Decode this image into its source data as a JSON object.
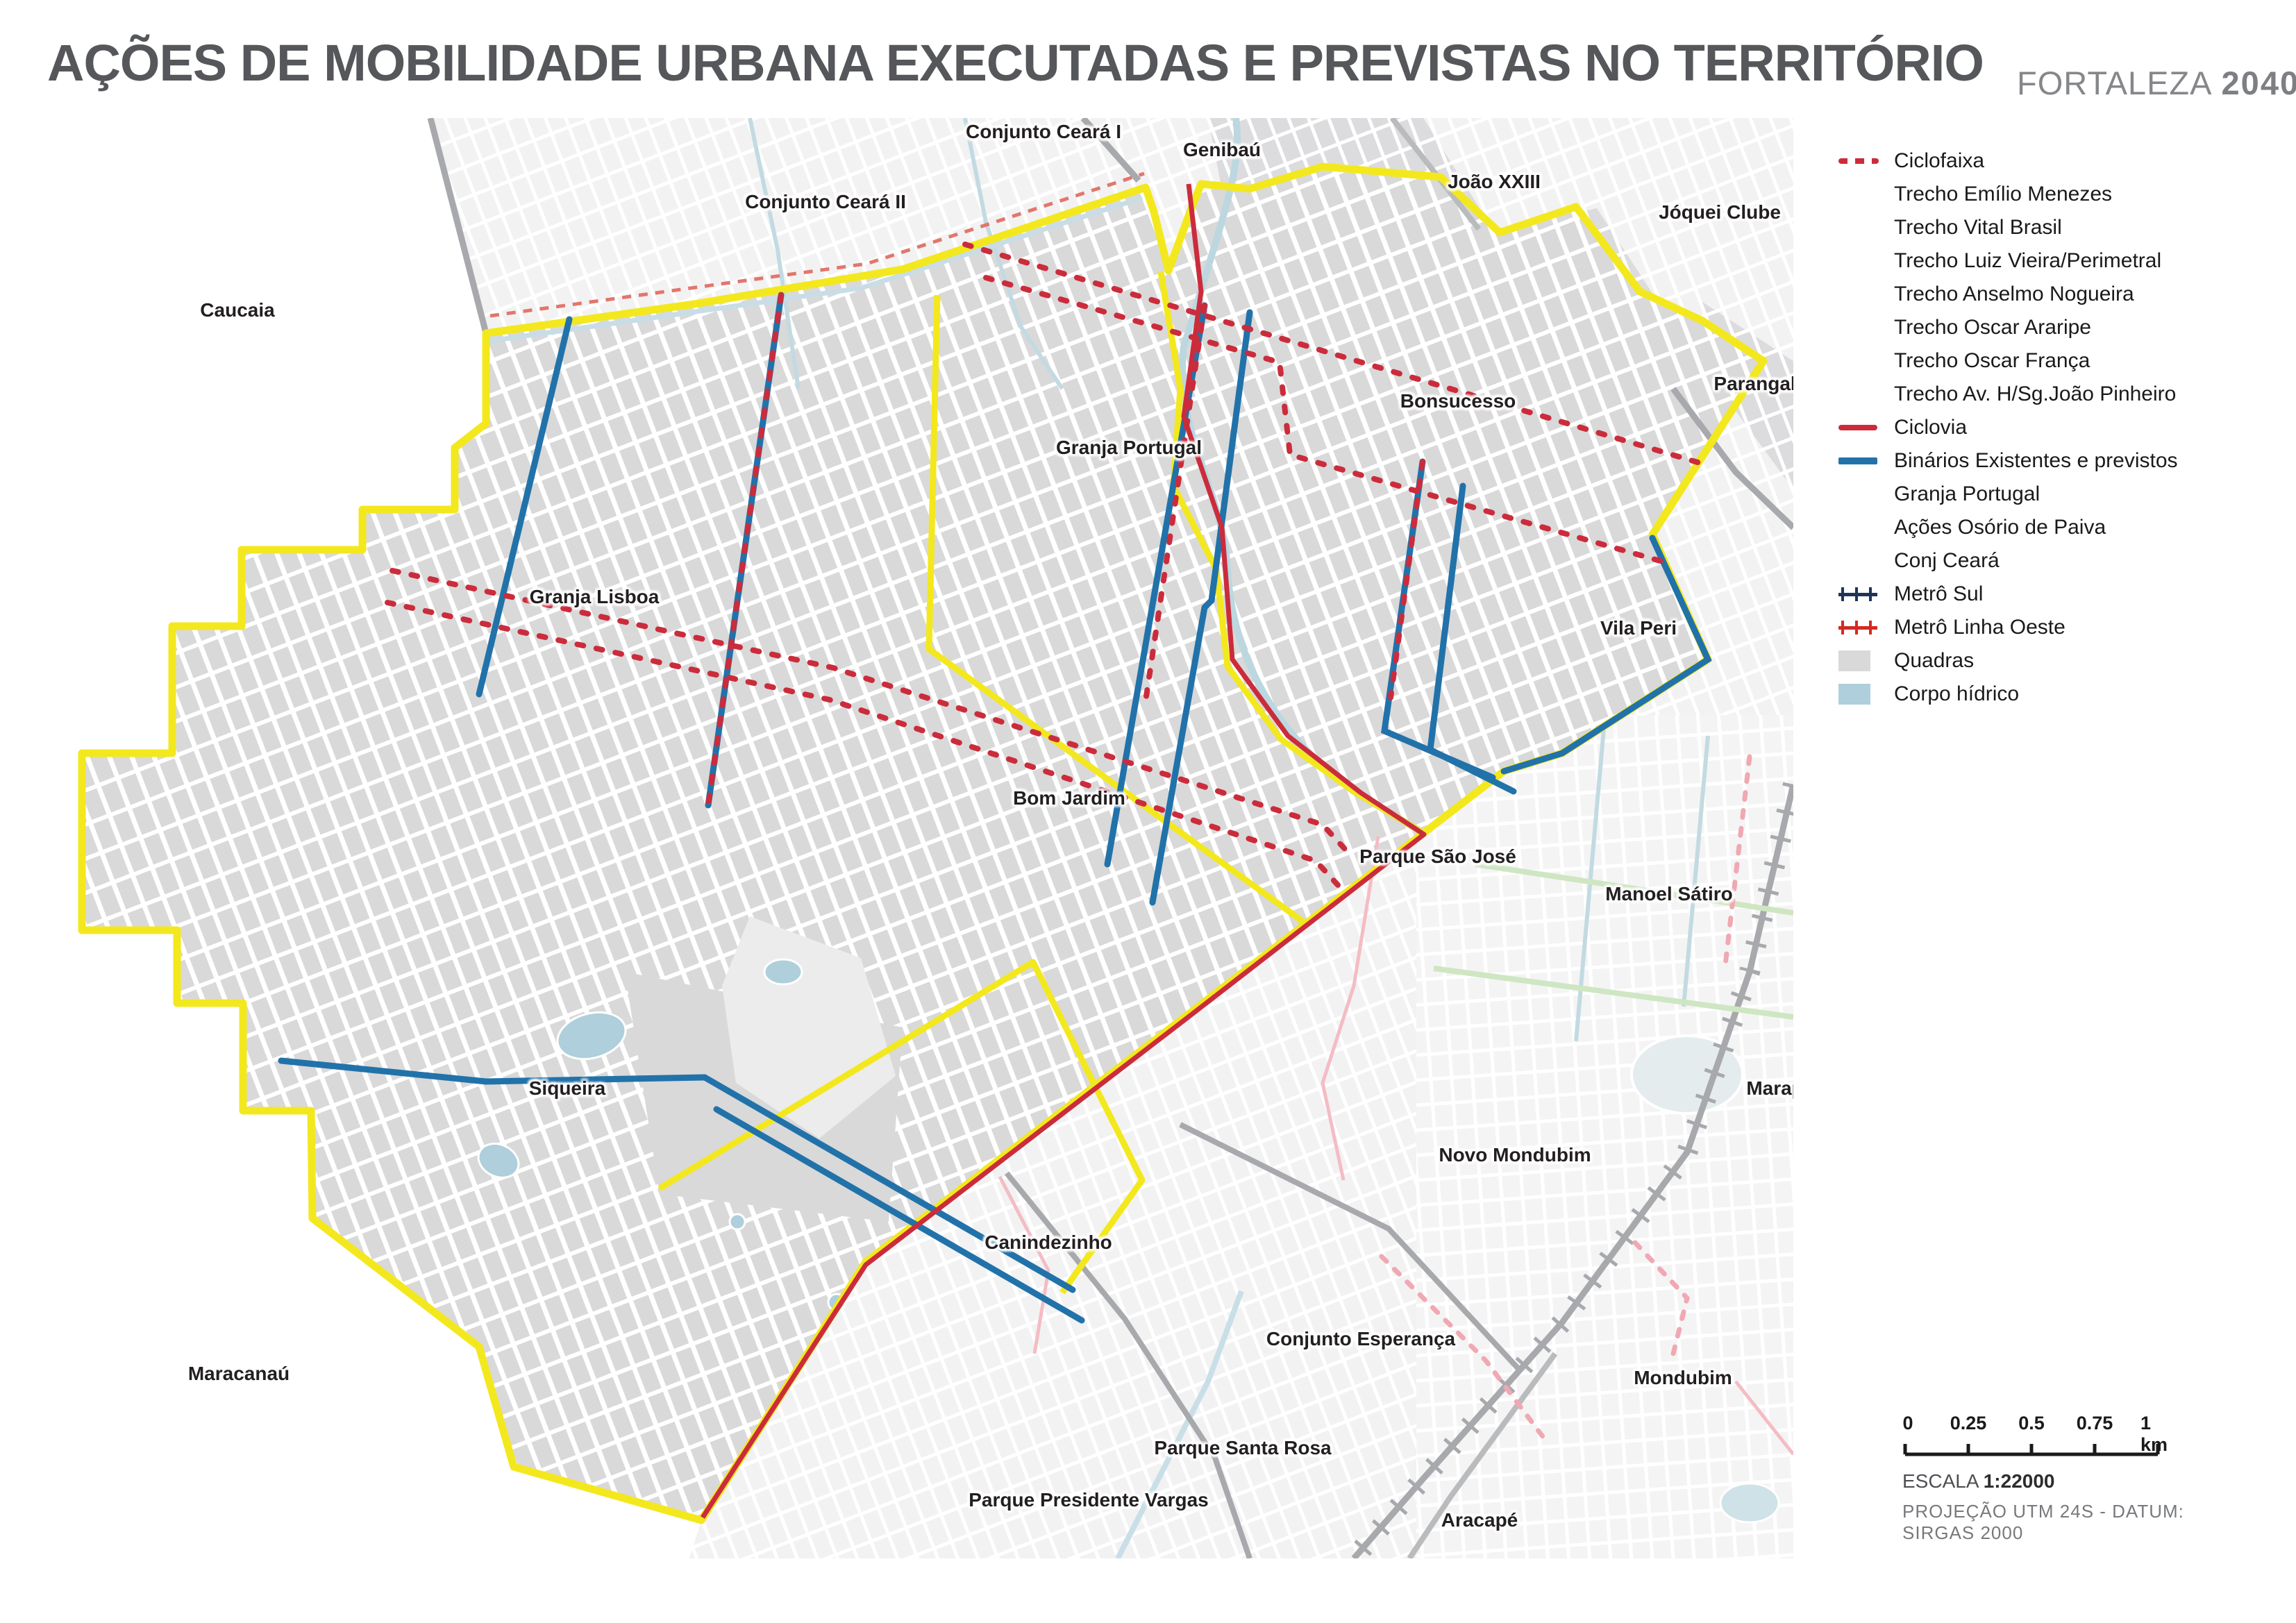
{
  "title": "AÇÕES DE MOBILIDADE URBANA EXECUTADAS E PREVISTAS NO TERRITÓRIO",
  "brand": {
    "name": "FORTALEZA",
    "year": "2040"
  },
  "north_label": "N",
  "legend": {
    "items": [
      {
        "label": "Ciclofaixa",
        "symbol": "ciclofaixa-dashed-red"
      },
      {
        "label": "Trecho Emílio Menezes",
        "symbol": "none"
      },
      {
        "label": "Trecho Vital Brasil",
        "symbol": "none"
      },
      {
        "label": "Trecho Luiz Vieira/Perimetral",
        "symbol": "none"
      },
      {
        "label": "Trecho Anselmo Nogueira",
        "symbol": "none"
      },
      {
        "label": "Trecho Oscar Araripe",
        "symbol": "none"
      },
      {
        "label": "Trecho Oscar França",
        "symbol": "none"
      },
      {
        "label": "Trecho Av. H/Sg.João Pinheiro",
        "symbol": "none"
      },
      {
        "label": "Ciclovia",
        "symbol": "solid-red-line"
      },
      {
        "label": "Binários Existentes e previstos",
        "symbol": "solid-blue-line"
      },
      {
        "label": "Granja Portugal",
        "symbol": "none"
      },
      {
        "label": "Ações Osório de Paiva",
        "symbol": "none"
      },
      {
        "label": "Conj Ceará",
        "symbol": "none"
      },
      {
        "label": "Metrô Sul",
        "symbol": "navy-railway-line"
      },
      {
        "label": "Metrô Linha Oeste",
        "symbol": "red-railway-line"
      },
      {
        "label": "Quadras",
        "symbol": "gray-square"
      },
      {
        "label": "Corpo hídrico",
        "symbol": "lightblue-square"
      }
    ]
  },
  "map": {
    "labels": [
      {
        "text": "Conjunto Ceará I"
      },
      {
        "text": "Genibaú"
      },
      {
        "text": "João XXIII"
      },
      {
        "text": "Jóquei Clube"
      },
      {
        "text": "Conjunto Ceará II"
      },
      {
        "text": "Caucaia"
      },
      {
        "text": "Parangaba"
      },
      {
        "text": "Bonsucesso"
      },
      {
        "text": "Granja Portugal"
      },
      {
        "text": "Granja Lisboa"
      },
      {
        "text": "Vila Peri"
      },
      {
        "text": "Bom Jardim"
      },
      {
        "text": "Parque São José"
      },
      {
        "text": "Manoel Sátiro"
      },
      {
        "text": "Siqueira"
      },
      {
        "text": "Maraponga"
      },
      {
        "text": "Novo Mondubim"
      },
      {
        "text": "Canindezinho"
      },
      {
        "text": "Conjunto Esperança"
      },
      {
        "text": "Mondubim"
      },
      {
        "text": "Maracanaú"
      },
      {
        "text": "Parque Santa Rosa"
      },
      {
        "text": "Parque Presidente Vargas"
      },
      {
        "text": "Aracapé"
      }
    ]
  },
  "scalebar": {
    "ticks": [
      "0",
      "0.25",
      "0.5",
      "0.75",
      "1 km"
    ],
    "scale_label": "ESCALA",
    "scale_value": "1:22000",
    "projection": "PROJEÇÃO UTM 24S - DATUM: SIRGAS 2000"
  },
  "colors": {
    "territory_boundary_yellow": "#f3e81e",
    "cicло_red": "#cb2c3c",
    "binarios_blue": "#2272aa",
    "metro_sul_navy": "#1f3557",
    "metro_oeste_red": "#d42a23",
    "quadras_gray": "#d9d9d9",
    "corpo_hidrico_blue": "#aecfdb"
  }
}
